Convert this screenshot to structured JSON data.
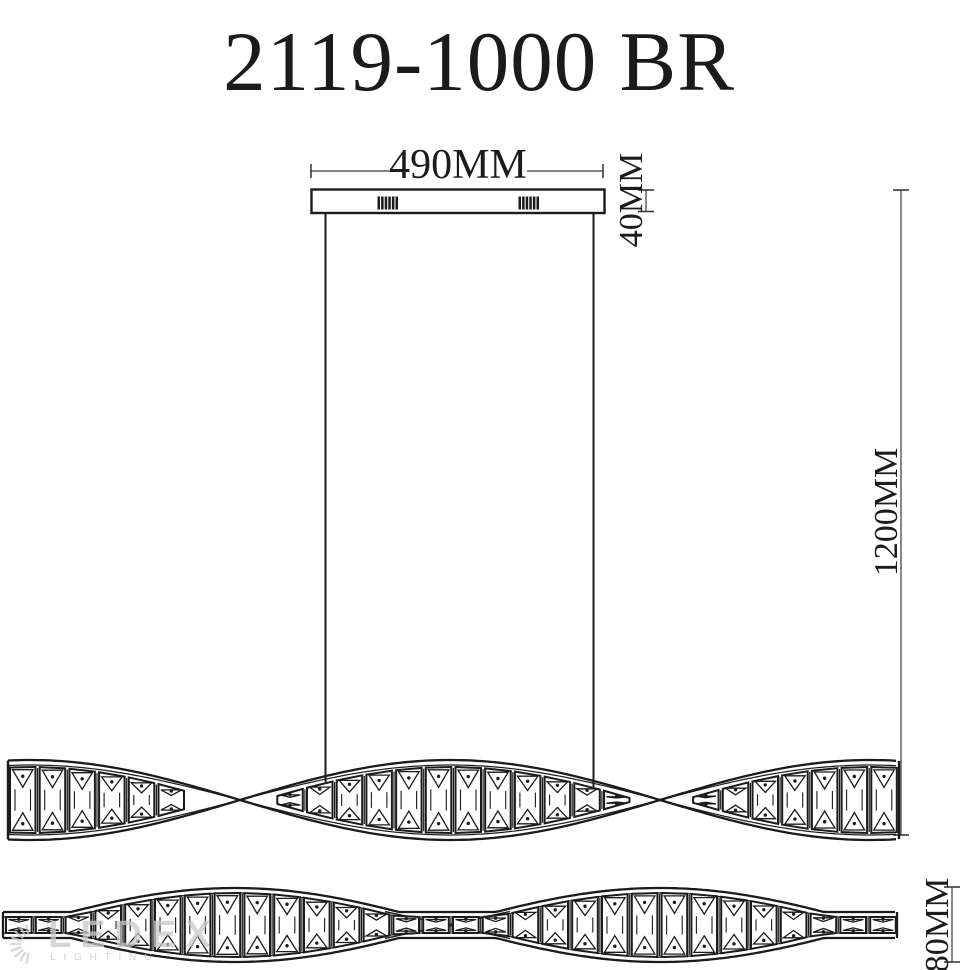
{
  "title": "2119-1000 BR",
  "dimensions": {
    "canopy_width": "490MM",
    "canopy_height": "40MM",
    "suspension_height": "1200MM",
    "fixture_height": "80MM"
  },
  "watermark": {
    "brand": "LEDEX",
    "subtitle": "LIGHTING",
    "icon": "sunburst-icon"
  },
  "colors": {
    "line": "#1b1b1b",
    "dim": "#3a3a3a",
    "watermark": "#c9c9c9",
    "background": "#ffffff"
  }
}
